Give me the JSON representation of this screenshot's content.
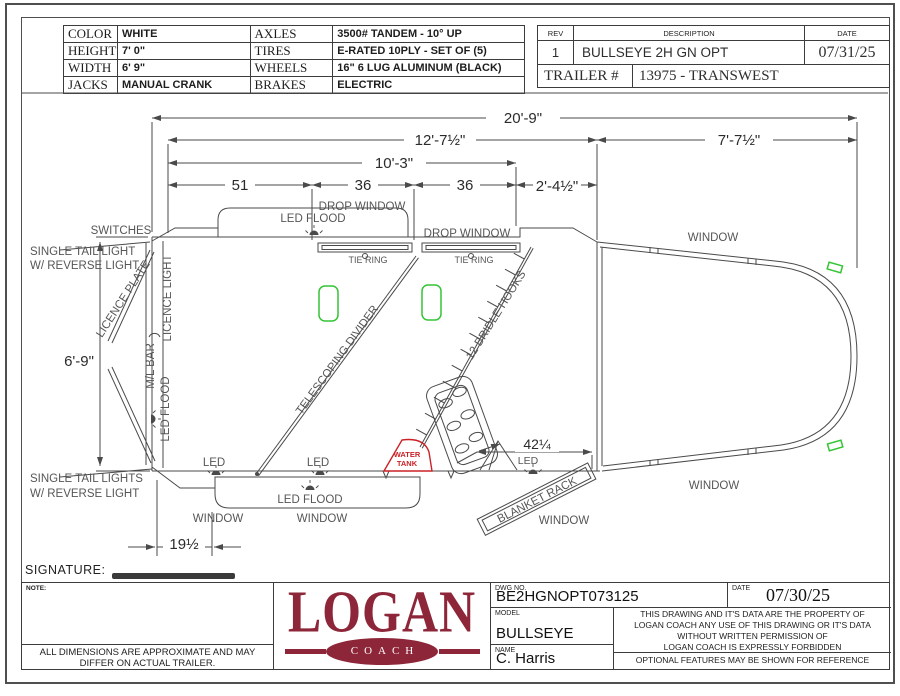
{
  "spec_table": {
    "rows": [
      {
        "k1": "COLOR",
        "v1": "WHITE",
        "k2": "AXLES",
        "v2": "3500# TANDEM - 10° UP"
      },
      {
        "k1": "HEIGHT",
        "v1": "7' 0\"",
        "k2": "TIRES",
        "v2": "E-RATED 10PLY - SET OF (5)"
      },
      {
        "k1": "WIDTH",
        "v1": "6' 9\"",
        "k2": "WHEELS",
        "v2": "16\" 6 LUG ALUMINUM (BLACK)"
      },
      {
        "k1": "JACKS",
        "v1": "MANUAL CRANK",
        "k2": "BRAKES",
        "v2": "ELECTRIC"
      }
    ]
  },
  "rev_table": {
    "rev_header": "REV",
    "description_header": "DESCRIPTION",
    "date_header": "DATE",
    "rev": "1",
    "description": "BULLSEYE 2H GN OPT",
    "date": "07/31/25",
    "trailer_label": "TRAILER #",
    "trailer_number": "13975 - TRANSWEST"
  },
  "drawing": {
    "dims": {
      "overall_length": "20'-9\"",
      "floor_length": "12'-7½\"",
      "gooseneck": "7'-7½\"",
      "stall_length": "10'-3\"",
      "d51": "51",
      "d36a": "36",
      "d36b": "36",
      "d2_4": "2'-4½\"",
      "width": "6'-9\"",
      "rear_tack": "42¼",
      "rear_step": "19½"
    },
    "labels": {
      "switches": "SWITCHES",
      "tail_light_top1": "SINGLE TAIL LIGHT",
      "tail_light_top2": "W/ REVERSE LIGHT",
      "tail_light_bot1": "SINGLE TAIL LIGHTS",
      "tail_light_bot2": "W/ REVERSE LIGHT",
      "licence_plate": "LICENCE PLATE",
      "licence_light": "LICENCE LIGHT",
      "ml_bar": "M/L BAR",
      "led_flood_left": "LED FLOOD",
      "led_flood_top": "LED FLOOD",
      "led_flood_bottom": "LED FLOOD",
      "drop_window_1": "DROP WINDOW",
      "drop_window_2": "DROP WINDOW",
      "tie_ring_1": "TIE RING",
      "tie_ring_2": "TIE RING",
      "telescoping_divider": "TELESCOPING DIVIDER",
      "bridle_hooks": "12 BRIDLE HOOKS",
      "water_tank_1": "WATER",
      "water_tank_2": "TANK",
      "blanket_rack": "BLANKET RACK",
      "led_1": "LED",
      "led_2": "LED",
      "led_3": "LED",
      "window_1": "WINDOW",
      "window_2": "WINDOW",
      "window_3": "WINDOW",
      "window_gooseneck_top": "WINDOW",
      "window_gooseneck_bottom": "WINDOW",
      "signature": "SIGNATURE:"
    }
  },
  "title_block": {
    "note_label": "NOTE:",
    "disclaimer_1": "ALL DIMENSIONS ARE APPROXIMATE AND MAY",
    "disclaimer_2": "DIFFER ON ACTUAL TRAILER.",
    "logo_text": "LOGAN",
    "logo_sub": "COACH",
    "dwg_label": "DWG NO.",
    "dwg_no": "BE2HGNOPT073125",
    "date_label": "DATE",
    "date": "07/30/25",
    "model_label": "MODEL",
    "model": "BULLSEYE",
    "name_label": "NAME",
    "name": "C. Harris",
    "legal_1": "THIS DRAWING AND IT'S DATA ARE THE PROPERTY OF",
    "legal_2": "LOGAN COACH ANY USE OF THIS DRAWING OR IT'S DATA",
    "legal_3": "WITHOUT WRITTEN PERMISSION OF",
    "legal_4": "LOGAN COACH IS EXPRESSLY FORBIDDEN",
    "optional_note": "OPTIONAL FEATURES MAY BE SHOWN FOR REFERENCE"
  },
  "colors": {
    "line": "#4a4a4a",
    "accent_red": "#cc2127",
    "accent_green": "#35c435",
    "logo_maroon": "#8e2639"
  }
}
